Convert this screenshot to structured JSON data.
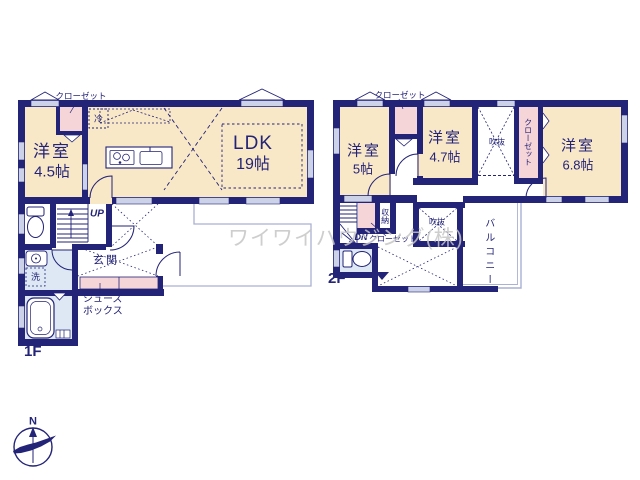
{
  "watermark": "ワイワイハウジング(株)",
  "compass": {
    "north_label": "N"
  },
  "floor1": {
    "floor_label": "1F",
    "western_room": {
      "label": "洋室",
      "size": "4.5帖"
    },
    "ldk": {
      "label": "LDK",
      "size": "19帖"
    },
    "entrance": {
      "label": "玄関"
    },
    "shoes_box": {
      "label": "シューズ\nボックス"
    },
    "closet": {
      "label": "クローゼット"
    },
    "refrigerator": {
      "label": "冷"
    },
    "laundry": {
      "label": "洗"
    },
    "stairs": {
      "label": "UP"
    }
  },
  "floor2": {
    "floor_label": "2F",
    "western_room_5": {
      "label": "洋室",
      "size": "5帖"
    },
    "western_room_47": {
      "label": "洋室",
      "size": "4.7帖"
    },
    "western_room_68": {
      "label": "洋室",
      "size": "6.8帖"
    },
    "closet_top": {
      "label": "クローゼット"
    },
    "closet_wall": {
      "label": "クローゼット"
    },
    "closet_stairs": {
      "label": "クローゼット"
    },
    "storage": {
      "label": "収納"
    },
    "void_upper": {
      "label": "吹抜"
    },
    "void_lower": {
      "label": "吹抜"
    },
    "balcony": {
      "label": "バルコニー"
    },
    "stairs": {
      "label": "DN"
    }
  },
  "colors": {
    "wall": "#232377",
    "room_cream": "#f8e8c8",
    "closet_pink": "#f6d5d8",
    "bath_blue": "#dde8f4",
    "thin_line": "#a9b1d4",
    "watermark_gray": "#c6c6c6"
  }
}
